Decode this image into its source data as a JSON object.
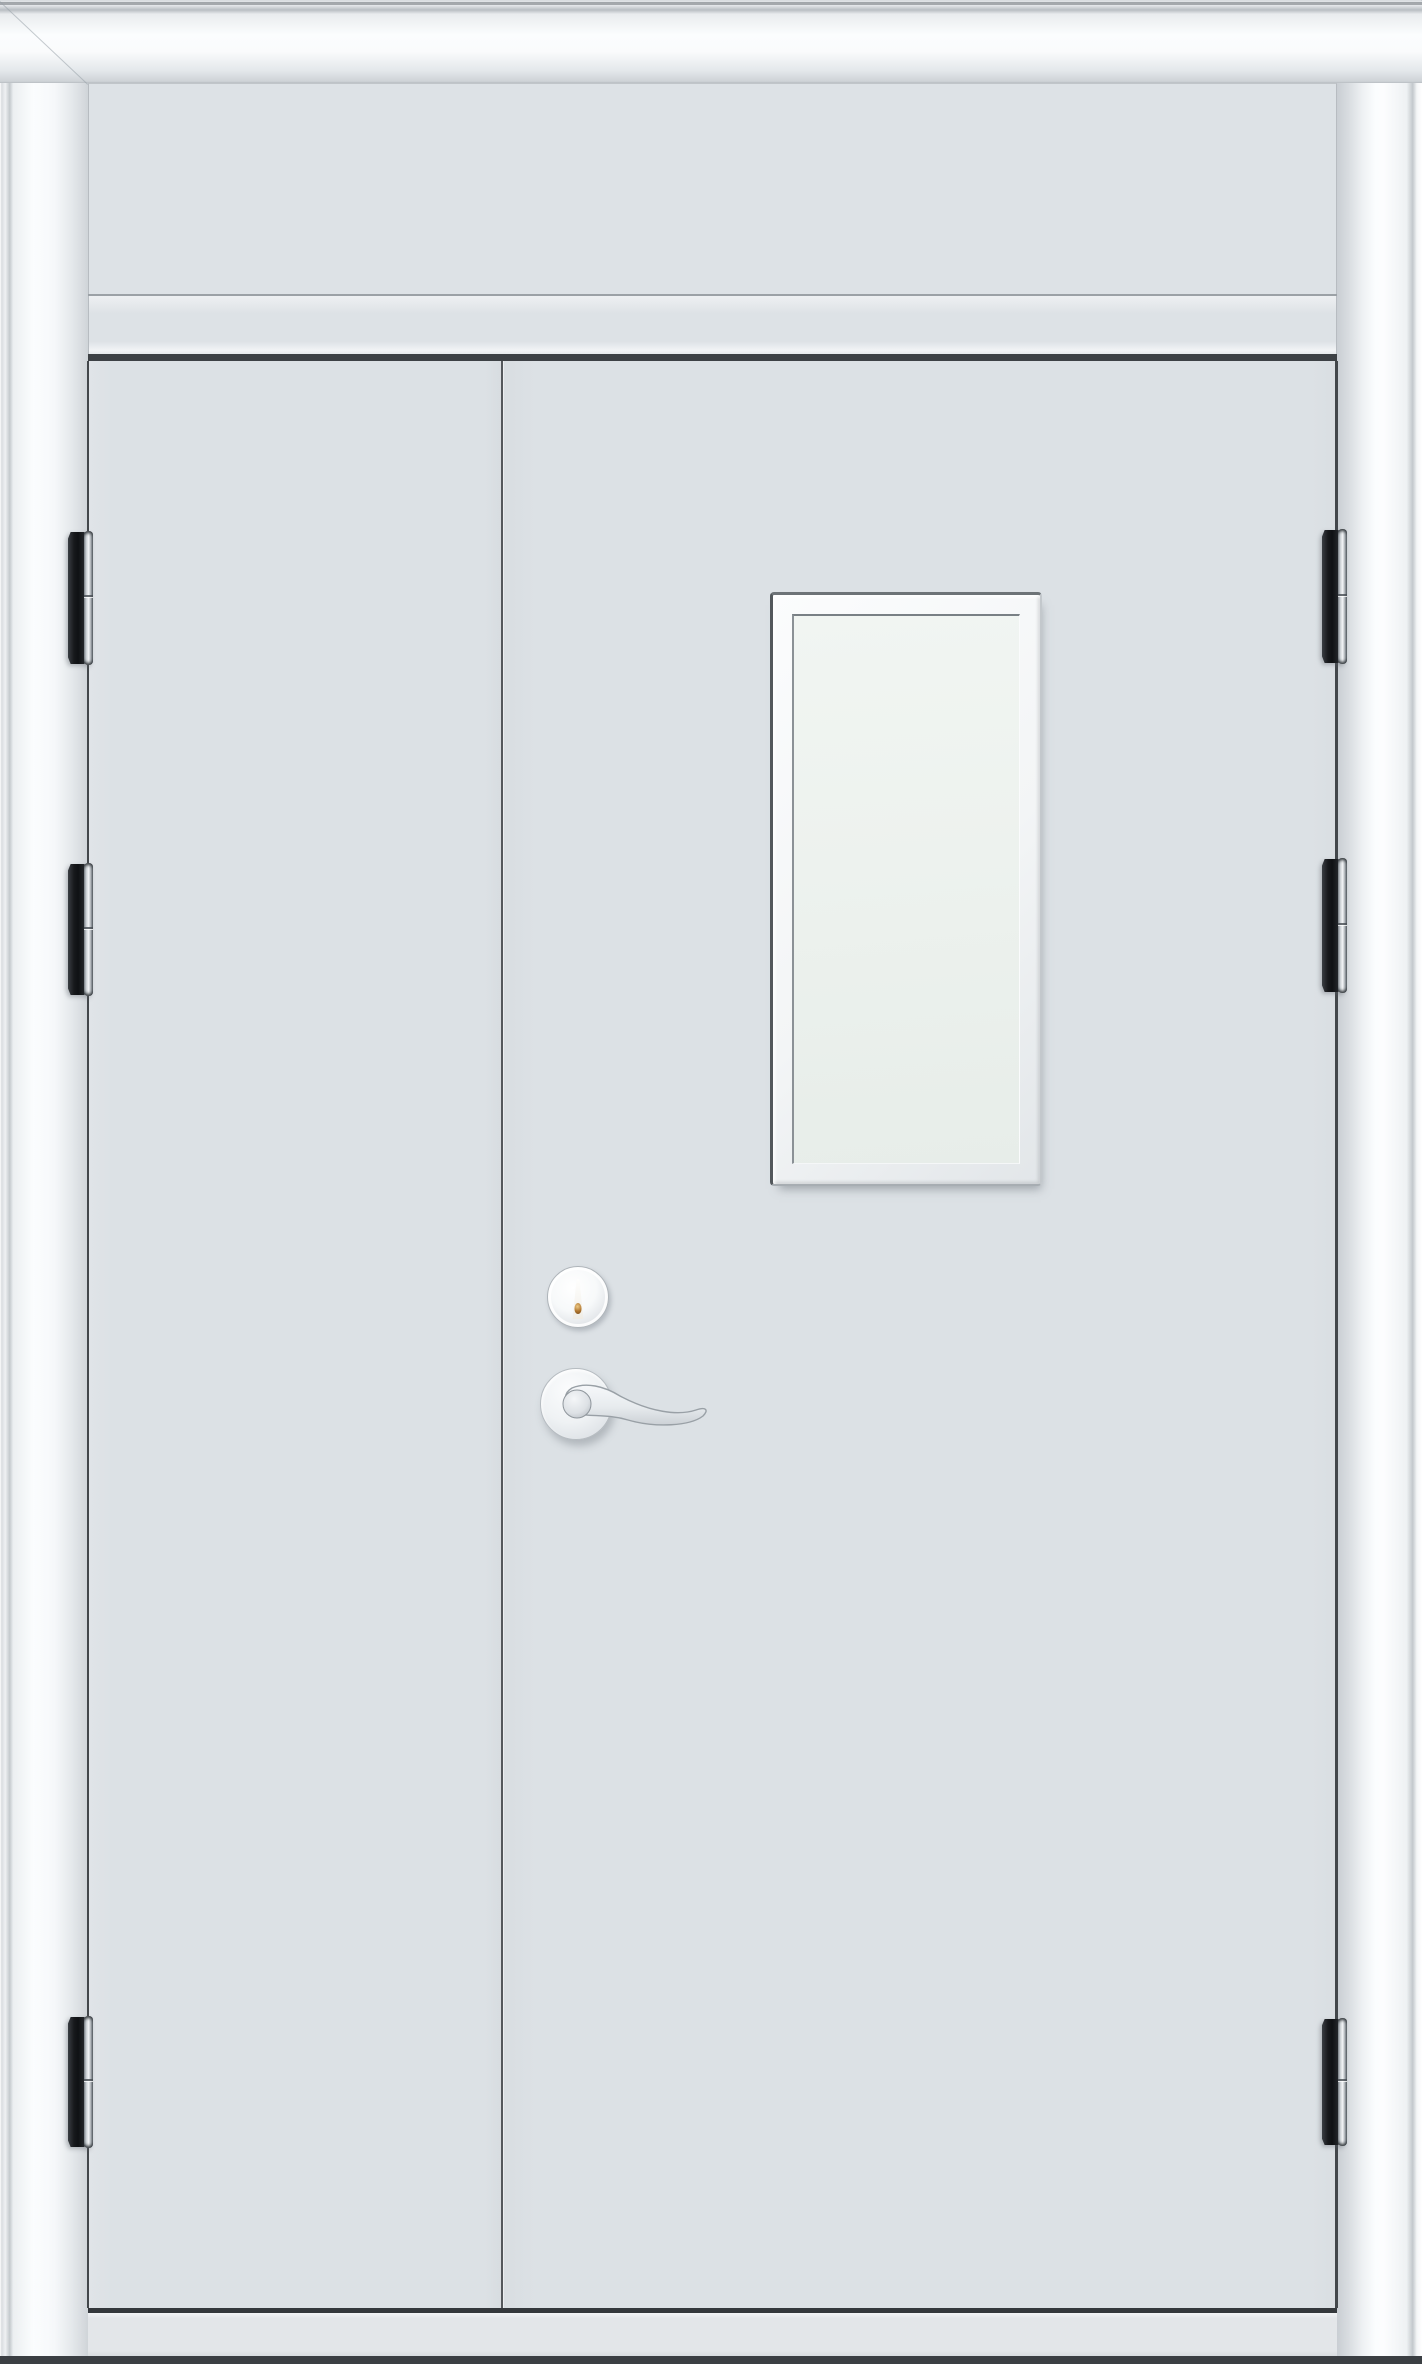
{
  "scene": {
    "description": "Front view product photo of a white steel unequal double-leaf door set: moulded white frame, plain transom panel above, narrow left leaf and wide right leaf, rectangular vision window in the right leaf, round cylinder lock with brass keyhole, stainless lever handle on a round rose, and three dark barrel hinges on each jamb.",
    "text_content": "none"
  },
  "colors": {
    "page_bg": "#ffffff",
    "frame_highlight": "#fbfdfe",
    "frame_shade": "#d6dadd",
    "panel": "#dde2e6",
    "door_face": "#dce1e5",
    "edge_line": "#43474b",
    "gap_dark": "#3d4145",
    "glass": "#edf2ee",
    "glass_deep": "#e7ede9",
    "window_frame": "#f3f5f6",
    "hinge_dark": "#17191c",
    "hinge_metal_light": "#f3f5f7",
    "hinge_metal_mid": "#aab0b5",
    "hinge_metal_dark": "#595f65",
    "keyhole_amber": "#b0762f",
    "threshold": "#e3e6e9",
    "floor_strip": "#3b3f43"
  },
  "layout": {
    "canvas": {
      "w": 1422,
      "h": 2364
    },
    "frame_top": {
      "x": 0,
      "y": 0,
      "w": 1422,
      "h": 83
    },
    "top_edge_line": {
      "x": 0,
      "y": 2,
      "w": 1422,
      "h": 3
    },
    "frame_left": {
      "x": 0,
      "y": 83,
      "w": 88,
      "h": 2281
    },
    "frame_right": {
      "x": 1337,
      "y": 83,
      "w": 85,
      "h": 2281
    },
    "transom_panel": {
      "x": 88,
      "y": 83,
      "w": 1249,
      "h": 211
    },
    "transom_groove": {
      "x": 88,
      "y": 294,
      "w": 1249,
      "h": 2
    },
    "transom_rail": {
      "x": 88,
      "y": 296,
      "w": 1249,
      "h": 58
    },
    "door_gap_top": {
      "x": 88,
      "y": 354,
      "w": 1249,
      "h": 7
    },
    "door_leaf_left": {
      "x": 88,
      "y": 361,
      "w": 414,
      "h": 1947
    },
    "door_leaf_right": {
      "x": 502,
      "y": 361,
      "w": 835,
      "h": 1947
    },
    "left_edge_line": {
      "x": 87,
      "y": 361,
      "w": 2,
      "h": 1947
    },
    "right_edge_line": {
      "x": 1335,
      "y": 361,
      "w": 3,
      "h": 1947
    },
    "meeting_stile": {
      "x": 501,
      "y": 361,
      "w": 2,
      "h": 1947
    },
    "door_bottom_line": {
      "x": 88,
      "y": 2308,
      "w": 1249,
      "h": 5
    },
    "threshold": {
      "x": 88,
      "y": 2313,
      "w": 1249,
      "h": 43
    },
    "floor_strip": {
      "x": 0,
      "y": 2356,
      "w": 1422,
      "h": 8
    },
    "window_outer": {
      "x": 770,
      "y": 592,
      "w": 272,
      "h": 594
    },
    "window_glass": {
      "x": 792,
      "y": 614,
      "w": 228,
      "h": 550
    },
    "lever_area": {
      "x": 538,
      "y": 1370,
      "w": 185,
      "h": 80
    },
    "cylinder": {
      "cx": 578,
      "cy": 1297,
      "r": 31
    },
    "rose": {
      "cx": 576,
      "cy": 1404,
      "r": 36
    },
    "hinges": [
      {
        "side": "left",
        "x": 68,
        "y": 531,
        "w": 25,
        "h": 134
      },
      {
        "side": "left",
        "x": 68,
        "y": 863,
        "w": 25,
        "h": 133
      },
      {
        "side": "left",
        "x": 68,
        "y": 2016,
        "w": 25,
        "h": 132
      },
      {
        "side": "right",
        "x": 1322,
        "y": 529,
        "w": 25,
        "h": 135
      },
      {
        "side": "right",
        "x": 1322,
        "y": 858,
        "w": 25,
        "h": 135
      },
      {
        "side": "right",
        "x": 1322,
        "y": 2018,
        "w": 25,
        "h": 128
      }
    ]
  }
}
